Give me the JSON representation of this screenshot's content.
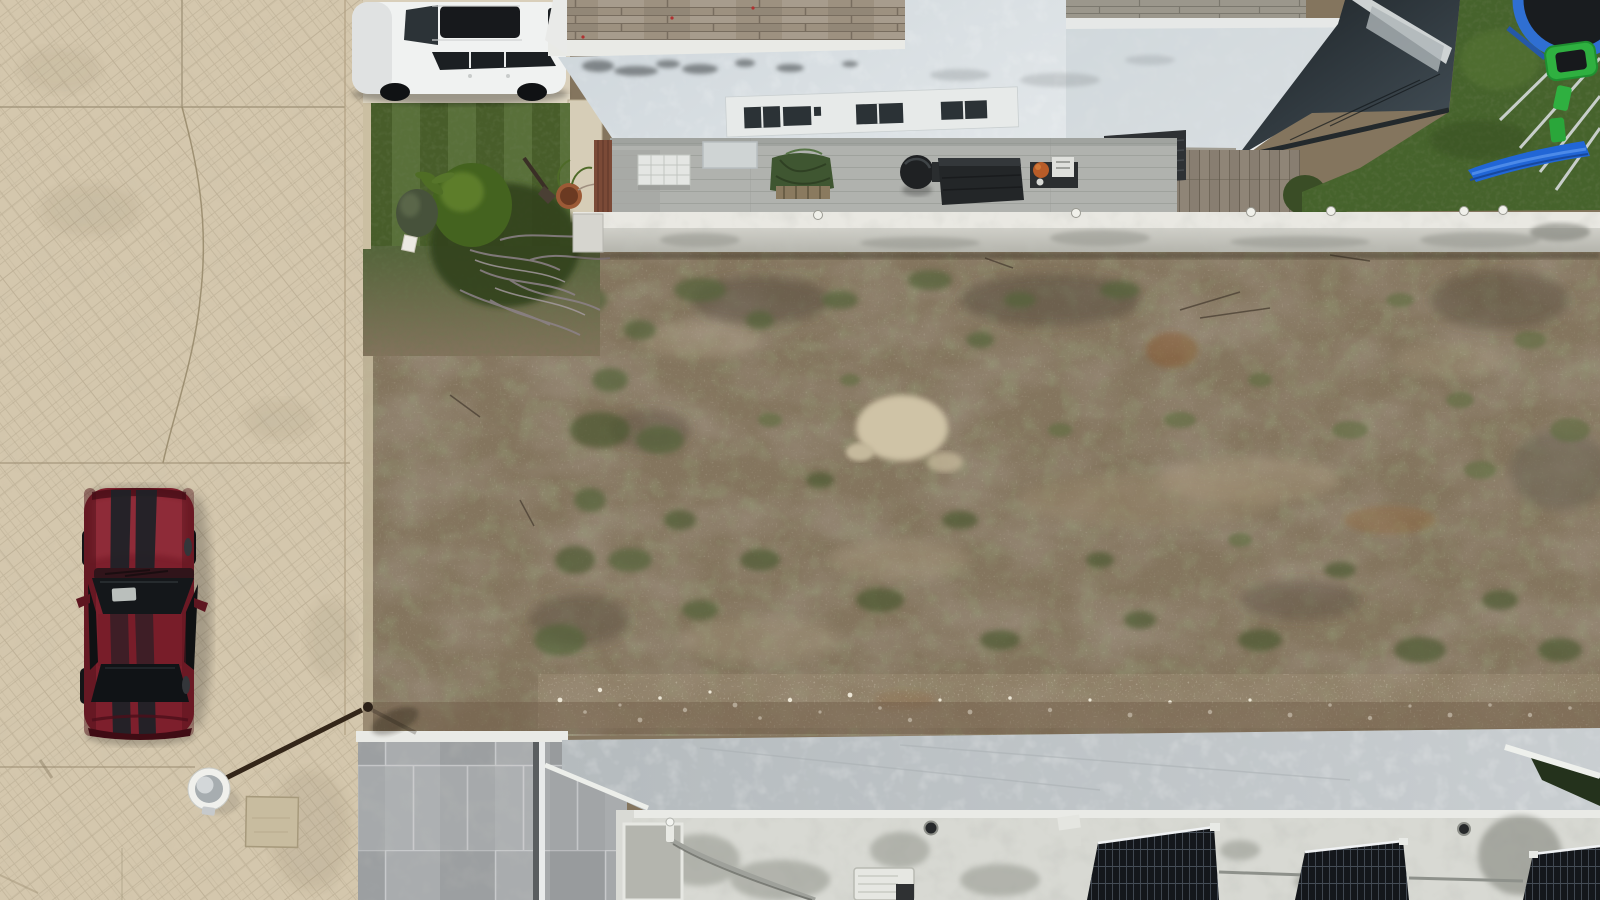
{
  "scene": {
    "type": "aerial-drone-photo",
    "description": "Top-down aerial photograph of a residential neighborhood: a vacant weedy dirt lot between two white houses, a stamped-concrete street on the left with a parked dark-red sports coupe and a street lamp seen from above, a white SUV on a driveway, a rear patio with furniture, a backyard playground with trampoline and blue slide, and neighboring flat roofs with solar panels at the bottom.",
    "objects": {
      "street": "beige stamped-concrete street with expansion joints and cracks",
      "red_car": "dark red sports coupe with twin black racing stripes parked facing up",
      "street_lamp": "street light with round lamp head and long arm seen from directly above",
      "utility_pad": "square concrete utility cover in the street",
      "white_suv": "white SUV with black sunroof parked on the driveway",
      "front_lawn": "mowed lawn strip with shrub cluster, dry branches and terracotta pot",
      "house": "white flat-roofed house with wood roof deck and clerestory window band",
      "patio": "concrete patio with tarp-covered furniture, kettle grill and deck boxes",
      "glass_canopy": "dark glass canopy over rear deck",
      "rooftop_unit": "black rooftop equipment boxes",
      "backyard": "green backyard with blue trampoline, green climber toys and blue slide",
      "boundary_wall": "white perimeter wall with round caps separating yards from the vacant lot",
      "vacant_lot": "bare dirt lot with weed patches, pale sand spot and white gravel band",
      "bottom_roofs": "gray stone-tiled roof and smooth concrete roof band of the neighboring house",
      "solar_panels": "three tilted black solar panels on a weathered white roof",
      "roof_equipment": "AC unit, drains and conduit piping on the lower roof",
      "hedge": "dark hedge tucked at the lower roof corner"
    }
  },
  "colors": {
    "street_base": "#d4c7ad",
    "driveway": "#d9cfba",
    "curb": "#cbbfa2",
    "dirt_base": "#84755e",
    "sand_patch": "#cfc3a6",
    "soil_band": "#6e5b46",
    "lawn_front": "#50682f",
    "lawn_back": "#46632c",
    "shrub_dark": "#33421f",
    "bush_green": "#44631f",
    "branches_gray": "#8d8289",
    "pot_terracotta": "#9c5a36",
    "suv_white": "#f0f2f1",
    "glass_dark": "#22292d",
    "roof_white": "#dde3e6",
    "wall_face": "#cfcfc7",
    "wall_top": "#e9e8e2",
    "deck_wood": "#9d9180",
    "deck_wood_b": "#9b978c",
    "deck_wood_c": "#8f8577",
    "patio_gray": "#b0b2ae",
    "fence_brown": "#7b4a37",
    "tarp_green": "#3f5631",
    "grill_black": "#1f2123",
    "box_black": "#232628",
    "unit_black": "#2e3134",
    "car_red": "#7d1f2c",
    "car_stripe": "#202227",
    "lamp_white": "#f0f0ec",
    "arm_brown": "#342619",
    "pad_concrete": "#c8bc9f",
    "tile_gray": "#a6a9ab",
    "band_gray": "#bcc2c5",
    "roof_weathered": "#d8d9d3",
    "trim_white": "#e9eae6",
    "solar_dark": "#14171b",
    "hedge_dark": "#24321c",
    "slide_blue": "#2166d6",
    "trampoline_blue": "#2f6fd2",
    "toy_green": "#2fb040",
    "window_dark": "#2b3236"
  }
}
